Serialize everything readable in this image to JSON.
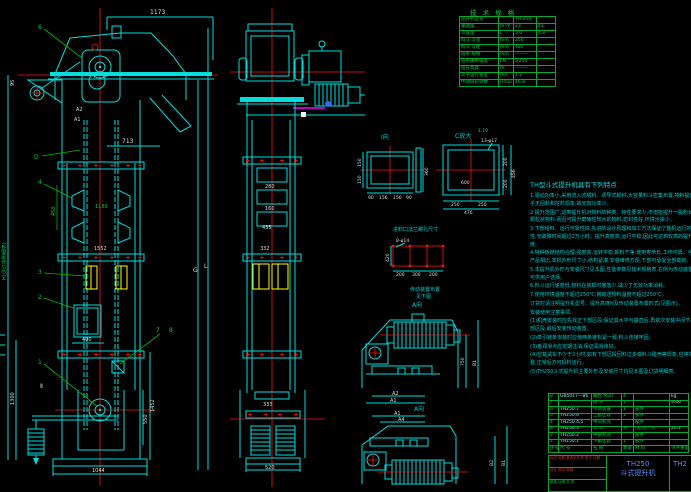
{
  "spec_table": {
    "title": "技 术 规 格",
    "rows": [
      {
        "l": "提升机型号",
        "u": "",
        "v1": "TH 250",
        "v2": ""
      },
      {
        "l": "输送量",
        "u": "m³/h",
        "v1": "23",
        "v2": "41"
      },
      {
        "l": "斗容量",
        "u": "L",
        "v1": "3.0",
        "v2": "4.8"
      },
      {
        "l": "料斗 斗宽",
        "u": "mm",
        "v1": "250",
        "v2": ""
      },
      {
        "l": "料斗 斗距",
        "u": "mm",
        "v1": "480",
        "v2": ""
      },
      {
        "l": "链条 规格",
        "u": "mm",
        "v1": "———",
        "v2": ""
      },
      {
        "l": "链条破断强度",
        "u": "kN",
        "v1": "≥250",
        "v2": ""
      },
      {
        "l": "提升高度",
        "u": "m",
        "v1": "———",
        "v2": ""
      },
      {
        "l": "斗子运行速度",
        "u": "m/s",
        "v1": "1.2",
        "v2": ""
      },
      {
        "l": "传动链轮转数",
        "u": "r/min",
        "v1": "46.8",
        "v2": ""
      }
    ]
  },
  "notes": {
    "title": "TH型斗式提升机具有下列特点",
    "lines": [
      "1.驱动功率小,采用流入式喂料、诱导式卸料,大容量料斗密集布置,物料提升时几乎无回料和挖料现象,故无效功率少。",
      "2.提升范围广,这类提升机对物料的种类、特性要求少,不但能提升一般粉状、小颗粒状物料,而且可提升磨琢性较大的物料,密封性好,环境污染少。",
      "3.下部给料、运行可靠性好,先进的设计原理和加工方法保证了整机运行的可靠性,无故障时间超过2万小时。提升高度高,运行平稳,因此可达到较高的提升高度。",
      "4.特种板链结构合理,强度高,运转平稳,卸料干净,使用寿命长,工作可靠。与同类产品相比,本机外形尺寸小,结构紧凑,安装维修方便,下部可承受全部载荷。",
      "5.本提升机外形与安装尺寸见本图,性能参数见技术规格表,右侧为传动装置布置,可供用户选择。",
      "6.料斗运行速度低,物料在装卸时撒落少,减少了无效功率消耗。",
      "7.使用环境温度不超过250℃,被输送物料温度不超过250℃。",
      "订货时请注明提升机型号、提升高度H及传动装置布置形式(见图示)。",
      "安装使用注意事项:",
      "(1)机壳安装时应先找正下部区段,保证其水平与垂直后,再依次安装中间节与上部区段,最后安装传动装置。",
      "(2)牵引链条安装时应使两条链松紧一致,料斗连接牢固。",
      "(3)各润滑点应定期注油,保证润滑良好。",
      "(4)空载试车不少于2小时,如有下部区段回料过多或料斗碰壳等现象,应停车调整,正常后方可投料运行。",
      "(5)TH250斗式提升机主要外形及安装尺寸均见本图及订货明细表。"
    ]
  },
  "bom": {
    "headers": [
      "序号",
      "代 号",
      "名 称",
      "数量",
      "材 料",
      "单件重量"
    ],
    "rows": [
      [
        "8",
        "GB5017—86",
        "螺栓 M20",
        "4",
        "",
        "kg"
      ],
      [
        "7",
        "",
        "链 条",
        "1",
        "",
        "9.06"
      ],
      [
        "6",
        "TH250.7",
        "传动装置",
        "1",
        "部件",
        ""
      ],
      [
        "5",
        "TH250.6",
        "上部区段",
        "1",
        "部件",
        ""
      ],
      [
        "4",
        "TH250.4,5",
        "中间机壳",
        "",
        "部件",
        ""
      ],
      [
        "3",
        "TH250.3",
        "料 斗",
        "条",
        "(见注)—A",
        "20.2"
      ],
      [
        "2",
        "TH250.2",
        "中部机壳",
        "",
        "部件",
        ""
      ],
      [
        "1",
        "TH250.1",
        "下部区段",
        "1",
        "部件",
        ""
      ]
    ]
  },
  "title_block": {
    "model": "TH250",
    "name": "斗式提升机",
    "right_no": "TH2",
    "rev1": "标记 处数 更改文件号 签字 日期",
    "rev2": "设计  校对  审核",
    "rev3": "批准  比例  共 张"
  },
  "labels": {
    "b1": "1",
    "b2": "2",
    "b3": "3",
    "b4": "4",
    "b6": "6",
    "b7": "7",
    "b8": "8",
    "d": "D",
    "sec": "Ⅱ",
    "view_i": "I向",
    "view_c": "C放大",
    "scale_c": "1:10",
    "view_a": "A向"
  },
  "dims": {
    "left": {
      "top": "1173",
      "mid": "713",
      "left_top": "95",
      "a2": "A2",
      "a1": "A1",
      "h": "H(见订货明细表)",
      "g": "G",
      "l": "L",
      "d450": "450",
      "d1180": "1180",
      "d1552": "1552",
      "d400": "400",
      "d1044": "1044",
      "d1300": "1300",
      "d1452": "1452",
      "d550": "550"
    },
    "mid": {
      "d280": "280",
      "d160": "160",
      "d435": "435",
      "d332": "332",
      "d333": "333",
      "d520": "520"
    },
    "i": {
      "l1": "150",
      "l2": "150",
      "r": "360",
      "b1": "90",
      "b2": "156",
      "b3": "156",
      "b4": "90"
    },
    "c": {
      "holes": "13-φ17",
      "center": "600",
      "b1": "250",
      "b2": "250",
      "b3": "476",
      "r1": "200",
      "r2": "200",
      "r3": "456"
    },
    "feed": {
      "title": "进料口法兰螺孔尺寸",
      "holes": "8-φ14",
      "left": "420",
      "b1": "200",
      "b2": "300",
      "b3": "200",
      "note1": "传动装置布置",
      "note2": "见下图"
    },
    "a1v": {
      "a2": "A2",
      "a1": "A1",
      "r1": "750",
      "r2": "B1"
    },
    "a2v": {
      "a1": "A1",
      "a4": "A4",
      "r1": "B2",
      "r2": "B1"
    }
  }
}
